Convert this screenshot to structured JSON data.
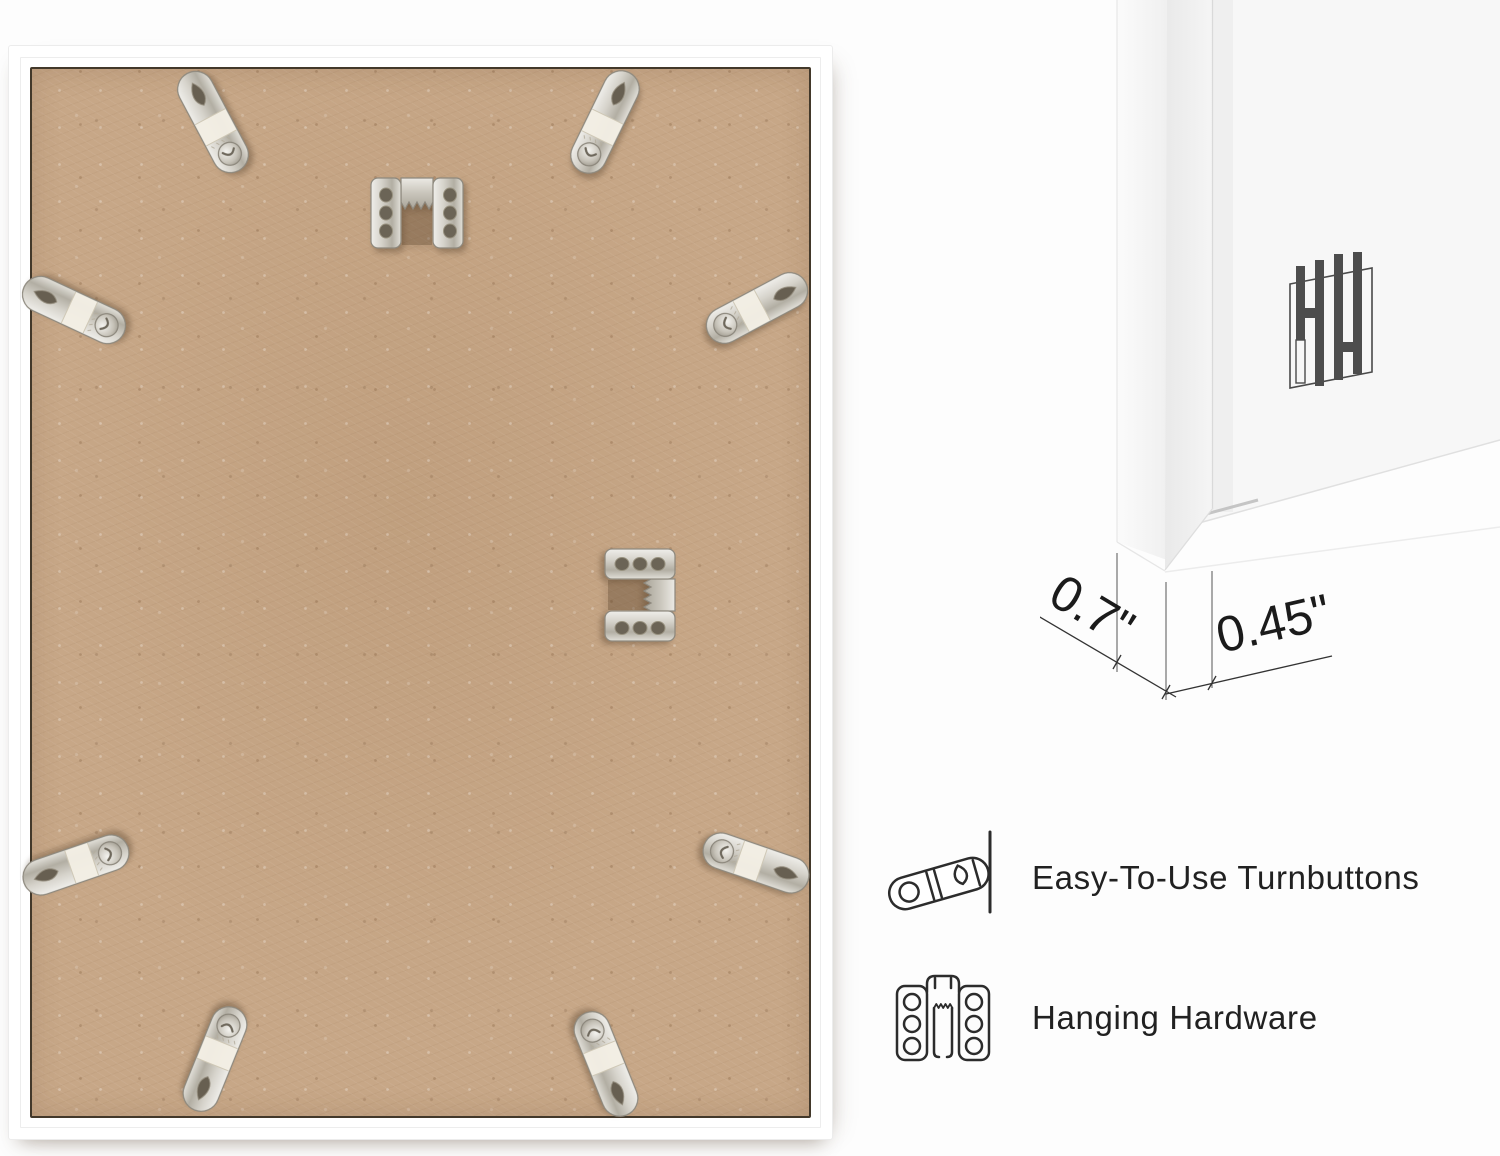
{
  "photo": {
    "subject": "Back of white picture frame with MDF backing board",
    "frame_color": "#ffffff",
    "board_color": "#c7a787",
    "turnbutton_count": 8,
    "sawtooth_hanger_count": 2
  },
  "detail": {
    "subject": "White frame corner profile close-up",
    "logo": "HH",
    "dim_side": "0.7\"",
    "dim_face": "0.45\""
  },
  "features": [
    {
      "icon": "turnbutton-icon",
      "label": "Easy-To-Use Turnbuttons"
    },
    {
      "icon": "sawtooth-hanger-icon",
      "label": "Hanging Hardware"
    }
  ],
  "colors": {
    "text": "#212121",
    "line": "#333333",
    "metal": "#cfccc4"
  }
}
